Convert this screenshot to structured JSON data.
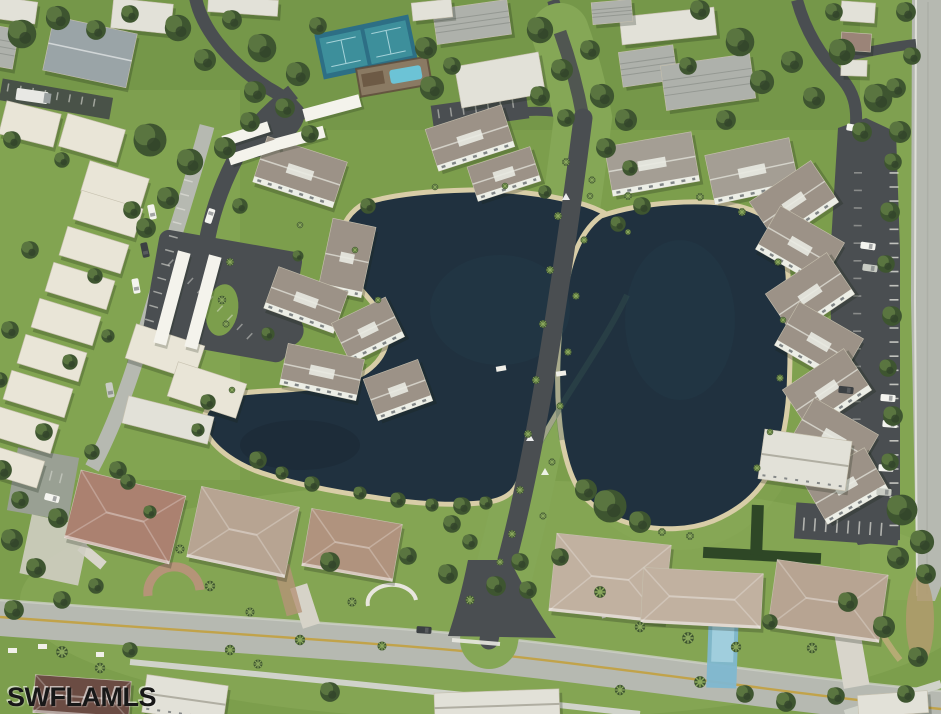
{
  "image": {
    "kind": "aerial-photo",
    "alt": "Oblique aerial photo of a lakeside residential community: two dark ponds divided by a palm-lined drive, condominium buildings and parking lots around the ponds, tennis courts and a swimming pool at top, rows of white apartment roofs on the left, and single-family homes along a concrete road at the bottom",
    "width_px": 941,
    "height_px": 714
  },
  "watermark": {
    "text": "SWFLAMLS"
  },
  "palette": {
    "watermark": "#181818",
    "grass": "#7c9e4c",
    "grassLight": "#8fae5d",
    "grassDark": "#6e8f45",
    "medianGrass": "#85a756",
    "treeDark": "#3e5530",
    "treeMid": "#5a7540",
    "treeDeep": "#32442a",
    "treeLight": "#8aa85c",
    "water": "#20313f",
    "waterLight": "#26404b",
    "waterDark": "#1a2833",
    "algae": "#3a5a50",
    "sand": "#d8cda7",
    "asphalt": "#4a4e51",
    "asphaltDark": "#404447",
    "concrete": "#b6b9b1",
    "concreteLight": "#cdd0c7",
    "sidewalk": "#d0d3ca",
    "yellowLine": "#c2a144",
    "cream": "#e9e5d7",
    "creamEdge": "#c6c0ae",
    "whiteRoof": "#e2e1d8",
    "metal": "#aeb1ab",
    "metalRidge": "#8e928c",
    "taupe": "#9c9287",
    "taupeLight": "#a49e94",
    "ridgeWhite": "#e9eae2",
    "wallWhite": "#eceee6",
    "windowDark": "#3a4147",
    "roofPink": "#ab8170",
    "roofTan": "#b7a492",
    "roofTerra": "#b0937e",
    "roofBeige": "#c1b1a0",
    "roofMaroon": "#6b4c43",
    "roofBlueGray": "#9aa4a7",
    "roofRed": "#9b8478",
    "tennis": "#2d6f85",
    "tennisCourt": "#3d8f9b",
    "tennisLine": "#bfe3e8",
    "pool": "#6cc3d6",
    "lapPool": "#7fb7d0",
    "lapPoolLight": "#a6d2e0",
    "pavers": "#b59478",
    "dirt": "#b09a6d",
    "hedge": "#2e4726",
    "carWhite": "#f4f4ef",
    "carDark": "#3c4043",
    "carGray": "#c9ccc4",
    "stripeWhite": "#e9e9e2"
  },
  "features": {
    "water": [
      "west-pond",
      "east-pond"
    ],
    "amenities": [
      "tennis-courts",
      "swimming-pool"
    ],
    "roads": [
      "main-road-bottom",
      "community-entrance-road",
      "pond-median-drive",
      "left-street",
      "right-boundary-road"
    ],
    "buildings": [
      "left-apartment-rows",
      "lakeside-condos",
      "right-condo-row",
      "single-family-homes",
      "carports"
    ],
    "vehicles": "parked-cars",
    "vegetation": [
      "lawns",
      "tree-canopy",
      "palm-trees"
    ]
  }
}
